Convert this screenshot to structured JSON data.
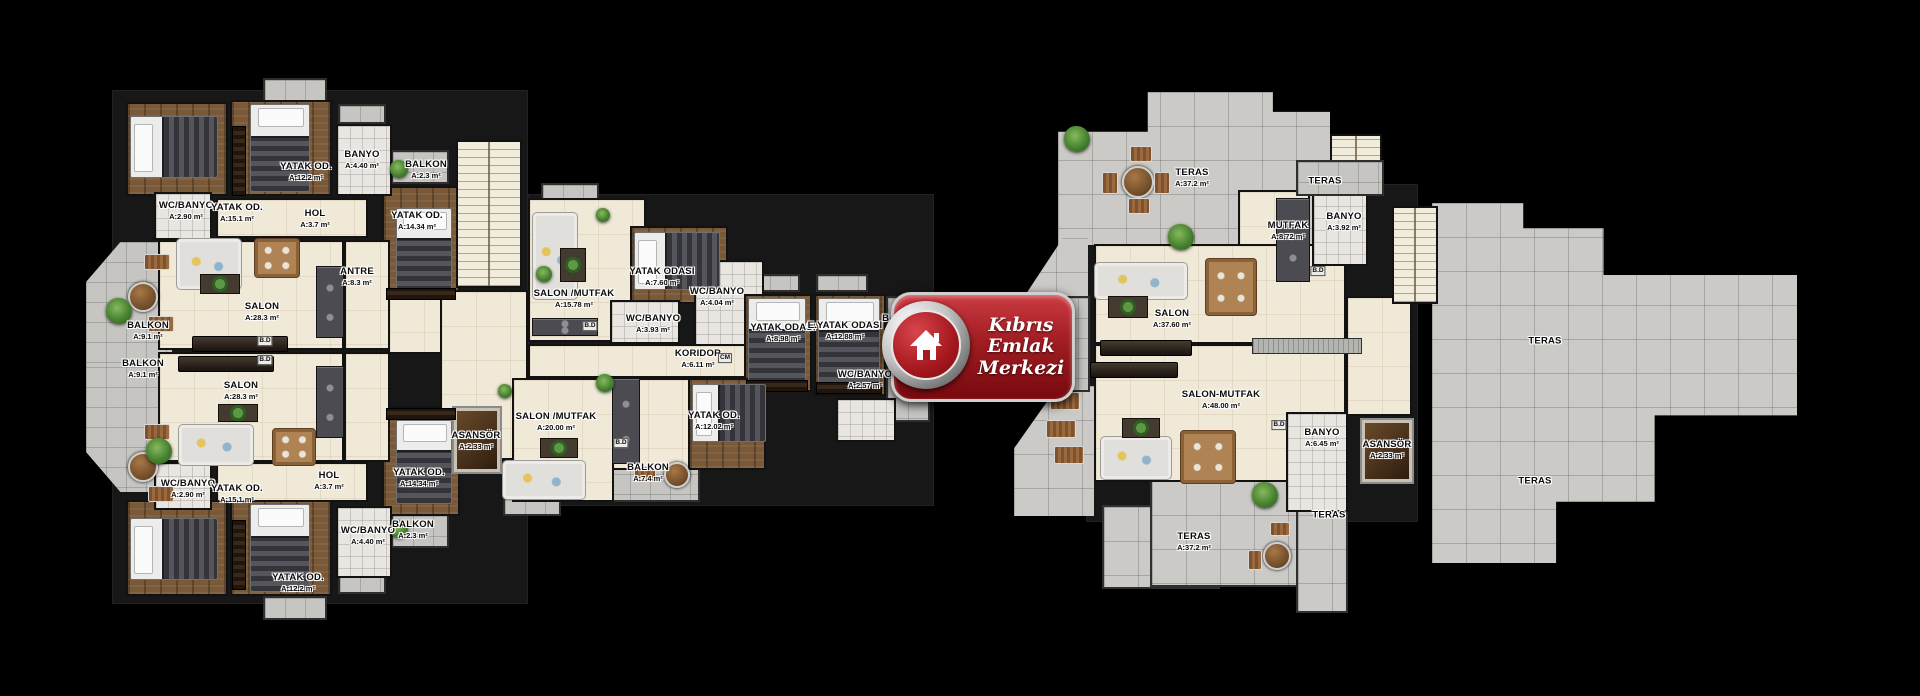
{
  "logo": {
    "lines": [
      "Kıbrıs",
      "Emlak",
      "Merkezi"
    ],
    "x": 891,
    "y": 292,
    "w": 178,
    "h": 104,
    "red": "#a01d22"
  },
  "colors": {
    "background": "#000000",
    "floor_beige": "#f0e9d7",
    "floor_wood": "#7a5938",
    "tile_gray": "#c6c5c1",
    "terrace_gray": "#cbcac6",
    "logo_red": "#a01d22"
  },
  "plan": {
    "typeNames": {
      "bk": "building-footprint",
      "bg": "room-floor",
      "wd": "bedroom-floor",
      "ba": "bathroom-floor",
      "tl": "balcony-tile",
      "t2": "terrace-tile",
      "st": "staircase",
      "lf": "elevator"
    },
    "furnNames": {
      "bv": "bed-icon",
      "bh": "bed-icon",
      "sf": "sofa-icon",
      "tb": "dining-table-icon",
      "cf": "coffee-table-icon",
      "pt": "patio-table-icon",
      "lg": "lounge-chair-icon",
      "pl": "plant-icon",
      "wr": "wardrobe-icon",
      "tv": "tv-console",
      "ct": "kitchen-counter",
      "cl": "kitchen-counter"
    },
    "rooms": [
      [
        "bk",
        112,
        90,
        416,
        514
      ],
      [
        "bk",
        528,
        194,
        406,
        312
      ],
      [
        "bk",
        1086,
        184,
        332,
        338
      ],
      [
        "tl",
        86,
        242,
        86,
        125,
        "polygon(40% 0,100% 0,100% 100%,0 100%,0 32%)"
      ],
      [
        "tl",
        86,
        367,
        86,
        125,
        "polygon(0 0,100% 0,100% 100%,40% 100%,0 68%)"
      ],
      [
        "tl",
        263,
        78,
        64,
        24
      ],
      [
        "tl",
        338,
        104,
        48,
        20
      ],
      [
        "tl",
        391,
        150,
        58,
        34
      ],
      [
        "tl",
        391,
        514,
        58,
        34
      ],
      [
        "tl",
        263,
        596,
        64,
        24
      ],
      [
        "tl",
        338,
        574,
        48,
        20
      ],
      [
        "tl",
        541,
        183,
        58,
        18
      ],
      [
        "tl",
        748,
        274,
        52,
        18
      ],
      [
        "tl",
        816,
        274,
        52,
        18
      ],
      [
        "tl",
        886,
        296,
        44,
        126
      ],
      [
        "tl",
        608,
        452,
        92,
        50
      ],
      [
        "tl",
        503,
        498,
        58,
        18
      ],
      [
        "t2",
        1058,
        92,
        272,
        153,
        "polygon(0 26%,33% 26%,33% 0,79% 0,79% 13%,100% 13%,100% 100%,0 100%)"
      ],
      [
        "t2",
        1102,
        505,
        118,
        84
      ],
      [
        "t2",
        1150,
        479,
        198,
        108
      ],
      [
        "t2",
        1296,
        479,
        52,
        134
      ],
      [
        "t2",
        1432,
        203,
        365,
        360,
        "polygon(0 0,25% 0,25% 7%,47% 7%,47% 20%,100% 20%,100% 59%,61% 59%,61% 83%,34% 83%,34% 100%,0 100%)"
      ],
      [
        "t2",
        1014,
        386,
        80,
        130,
        "polygon(55% 0,100% 0,100% 100%,0 100%,0 48%)"
      ],
      [
        "t2",
        1022,
        238,
        66,
        62,
        "polygon(62% 0,100% 0,100% 100%,0 100%)"
      ],
      [
        "tl",
        1036,
        296,
        54,
        96
      ],
      [
        "wd",
        126,
        102,
        102,
        94
      ],
      [
        "wd",
        230,
        100,
        102,
        96
      ],
      [
        "wd",
        382,
        186,
        78,
        116
      ],
      [
        "wd",
        382,
        406,
        78,
        110
      ],
      [
        "wd",
        126,
        500,
        102,
        96
      ],
      [
        "wd",
        230,
        500,
        102,
        96
      ],
      [
        "ba",
        336,
        124,
        56,
        72
      ],
      [
        "ba",
        154,
        192,
        58,
        48
      ],
      [
        "ba",
        154,
        462,
        58,
        48
      ],
      [
        "ba",
        336,
        506,
        56,
        72
      ],
      [
        "bg",
        216,
        198,
        152,
        40
      ],
      [
        "bg",
        216,
        462,
        152,
        40
      ],
      [
        "bg",
        158,
        240,
        186,
        110
      ],
      [
        "bg",
        158,
        352,
        186,
        110
      ],
      [
        "bg",
        344,
        240,
        46,
        110
      ],
      [
        "bg",
        344,
        352,
        46,
        110
      ],
      [
        "bg",
        388,
        296,
        76,
        58
      ],
      [
        "bg",
        440,
        290,
        88,
        170
      ],
      [
        "st",
        456,
        140,
        66,
        148
      ],
      [
        "lf",
        452,
        406,
        50,
        68
      ],
      [
        "bg",
        528,
        198,
        118,
        144
      ],
      [
        "wd",
        630,
        226,
        98,
        78
      ],
      [
        "ba",
        610,
        300,
        70,
        44
      ],
      [
        "ba",
        694,
        260,
        70,
        86
      ],
      [
        "bg",
        528,
        344,
        218,
        34
      ],
      [
        "wd",
        744,
        294,
        68,
        98
      ],
      [
        "wd",
        814,
        294,
        72,
        102
      ],
      [
        "ba",
        836,
        398,
        60,
        44
      ],
      [
        "bg",
        512,
        378,
        102,
        124
      ],
      [
        "bg",
        612,
        378,
        78,
        92
      ],
      [
        "wd",
        688,
        378,
        78,
        92
      ],
      [
        "bg",
        1094,
        244,
        252,
        100
      ],
      [
        "bg",
        1094,
        344,
        252,
        138
      ],
      [
        "bg",
        1238,
        190,
        72,
        56
      ],
      [
        "ba",
        1312,
        192,
        56,
        74
      ],
      [
        "ba",
        1286,
        412,
        62,
        100
      ],
      [
        "bg",
        1346,
        296,
        66,
        120
      ],
      [
        "lf",
        1360,
        418,
        54,
        66
      ],
      [
        "st",
        1392,
        206,
        46,
        98
      ],
      [
        "st",
        1330,
        134,
        52,
        48
      ],
      [
        "tl",
        1296,
        160,
        88,
        36
      ]
    ],
    "furniture": [
      [
        "bh",
        130,
        116,
        88,
        62
      ],
      [
        "bv",
        250,
        104,
        60,
        88
      ],
      [
        "wr",
        232,
        126,
        14,
        70
      ],
      [
        "bv",
        396,
        208,
        56,
        84
      ],
      [
        "wr",
        386,
        288,
        70,
        12
      ],
      [
        "bh",
        130,
        518,
        88,
        62
      ],
      [
        "bv",
        250,
        504,
        60,
        88
      ],
      [
        "wr",
        232,
        520,
        14,
        70
      ],
      [
        "bv",
        396,
        420,
        56,
        84
      ],
      [
        "wr",
        386,
        408,
        70,
        12
      ],
      [
        "sf",
        176,
        238,
        66,
        52
      ],
      [
        "tb",
        254,
        238,
        46,
        40
      ],
      [
        "cf",
        200,
        274,
        40,
        20
      ],
      [
        "tv",
        192,
        336,
        96,
        16
      ],
      [
        "tv",
        178,
        356,
        96,
        16
      ],
      [
        "sf",
        178,
        424,
        76,
        42
      ],
      [
        "tb",
        272,
        428,
        44,
        38
      ],
      [
        "cf",
        218,
        404,
        40,
        18
      ],
      [
        "ct",
        316,
        266,
        28,
        72
      ],
      [
        "ct",
        316,
        366,
        28,
        72
      ],
      [
        "pt",
        128,
        282,
        30,
        30
      ],
      [
        "lg",
        144,
        254,
        26,
        16
      ],
      [
        "lg",
        148,
        316,
        26,
        16
      ],
      [
        "pl",
        106,
        298,
        26,
        26
      ],
      [
        "pt",
        128,
        452,
        30,
        30
      ],
      [
        "lg",
        144,
        424,
        26,
        16
      ],
      [
        "lg",
        148,
        486,
        26,
        16
      ],
      [
        "pl",
        146,
        438,
        26,
        26
      ],
      [
        "pl",
        390,
        160,
        18,
        18
      ],
      [
        "pl",
        390,
        520,
        18,
        18
      ],
      [
        "sf",
        532,
        212,
        46,
        88
      ],
      [
        "cf",
        560,
        248,
        26,
        34
      ],
      [
        "ct",
        532,
        318,
        66,
        18
      ],
      [
        "pl",
        596,
        208,
        14,
        14
      ],
      [
        "pl",
        536,
        266,
        16,
        16
      ],
      [
        "bh",
        634,
        232,
        86,
        58
      ],
      [
        "bv",
        748,
        298,
        58,
        86
      ],
      [
        "bv",
        818,
        298,
        62,
        90
      ],
      [
        "wr",
        746,
        380,
        62,
        12
      ],
      [
        "wr",
        816,
        382,
        66,
        12
      ],
      [
        "lg",
        890,
        306,
        34,
        20
      ],
      [
        "lg",
        890,
        342,
        34,
        20
      ],
      [
        "sf",
        502,
        460,
        84,
        40
      ],
      [
        "cf",
        540,
        438,
        38,
        20
      ],
      [
        "ct",
        612,
        378,
        28,
        86
      ],
      [
        "pl",
        596,
        374,
        18,
        18
      ],
      [
        "bh",
        692,
        384,
        74,
        58
      ],
      [
        "pt",
        664,
        462,
        26,
        26
      ],
      [
        "lg",
        634,
        466,
        22,
        16
      ],
      [
        "pl",
        498,
        384,
        14,
        14
      ],
      [
        "pt",
        1122,
        166,
        32,
        32
      ],
      [
        "lg",
        1130,
        146,
        22,
        16
      ],
      [
        "lg",
        1102,
        172,
        16,
        22
      ],
      [
        "lg",
        1154,
        172,
        16,
        22
      ],
      [
        "lg",
        1128,
        198,
        22,
        16
      ],
      [
        "pl",
        1064,
        126,
        26,
        26
      ],
      [
        "pl",
        1168,
        224,
        26,
        26
      ],
      [
        "sf",
        1094,
        262,
        94,
        38
      ],
      [
        "tb",
        1205,
        258,
        52,
        58
      ],
      [
        "cf",
        1108,
        296,
        40,
        22
      ],
      [
        "tv",
        1100,
        340,
        92,
        16
      ],
      [
        "tv",
        1090,
        362,
        88,
        16
      ],
      [
        "cl",
        1252,
        338,
        110,
        16
      ],
      [
        "ct",
        1276,
        198,
        34,
        84
      ],
      [
        "sf",
        1100,
        436,
        72,
        44
      ],
      [
        "cf",
        1122,
        418,
        38,
        20
      ],
      [
        "tb",
        1180,
        430,
        56,
        54
      ],
      [
        "pl",
        1024,
        334,
        26,
        26
      ],
      [
        "pl",
        892,
        360,
        24,
        24
      ],
      [
        "lg",
        1050,
        392,
        30,
        18
      ],
      [
        "lg",
        1046,
        420,
        30,
        18
      ],
      [
        "lg",
        1054,
        446,
        30,
        18
      ],
      [
        "pt",
        1263,
        542,
        28,
        28
      ],
      [
        "lg",
        1270,
        522,
        20,
        14
      ],
      [
        "lg",
        1248,
        550,
        14,
        20
      ],
      [
        "pl",
        1252,
        482,
        26,
        26
      ]
    ],
    "labels": [
      [
        "YATAK OD.",
        "A:12.2 m²",
        306,
        172
      ],
      [
        "BANYO",
        "A:4.40 m²",
        362,
        160
      ],
      [
        "WC/BANYO",
        "A:2.90 m²",
        186,
        211
      ],
      [
        "YATAK OD.",
        "A:15.1 m²",
        237,
        213
      ],
      [
        "HOL",
        "A:3.7 m²",
        315,
        219
      ],
      [
        "ANTRE",
        "A:8.3 m²",
        357,
        277
      ],
      [
        "BALKON",
        "A:2.3 m²",
        426,
        170
      ],
      [
        "YATAK OD.",
        "A:14.34 m²",
        417,
        221
      ],
      [
        "SALON",
        "A:28.3 m²",
        262,
        312
      ],
      [
        "BALKON",
        "A:9.1 m²",
        148,
        331
      ],
      [
        "BALKON",
        "A:9.1 m²",
        143,
        369
      ],
      [
        "SALON",
        "A:28.3 m²",
        241,
        391
      ],
      [
        "WC/BANYO",
        "A:2.90 m²",
        188,
        489
      ],
      [
        "YATAK OD.",
        "A:15.1 m²",
        237,
        494
      ],
      [
        "HOL",
        "A:3.7 m²",
        329,
        481
      ],
      [
        "WC/BANYO",
        "A:4.40 m²",
        368,
        536
      ],
      [
        "YATAK OD.",
        "A:12.2 m²",
        298,
        583
      ],
      [
        "BALKON",
        "A:2.3 m²",
        413,
        530
      ],
      [
        "YATAK OD.",
        "A:14.34 m²",
        419,
        478
      ],
      [
        "ASANSÖR",
        "A:2.33 m²",
        476,
        441
      ],
      [
        "SALON /MUTFAK",
        "A:15.78 m²",
        574,
        299
      ],
      [
        "YATAK ODASI",
        "A:7.60 m²",
        662,
        277
      ],
      [
        "WC/BANYO",
        "A:4.04 m²",
        717,
        297
      ],
      [
        "WC/BANYO",
        "A:3.93 m²",
        653,
        324
      ],
      [
        "KORIDOR",
        "A:6.11 m²",
        698,
        359
      ],
      [
        "YATAK ODASI",
        "A:8.98 m²",
        783,
        333
      ],
      [
        "E.YATAK ODASI",
        "A:12.88 m²",
        845,
        331
      ],
      [
        "WC/BANYO",
        "A:2.57 m²",
        865,
        380
      ],
      [
        "BALKON",
        "A:5.6 m²",
        903,
        324
      ],
      [
        "SALON /MUTFAK",
        "A:20.00 m²",
        556,
        422
      ],
      [
        "YATAK OD.",
        "A:12.02 m²",
        714,
        421
      ],
      [
        "BALKON",
        "A:7.4 m²",
        648,
        473
      ],
      [
        "TERAS",
        "A:37.2 m²",
        1192,
        178
      ],
      [
        "TERAS",
        "",
        1325,
        182
      ],
      [
        "MUTFAK",
        "A:8.72 m²",
        1288,
        231
      ],
      [
        "BANYO",
        "A:3.92 m²",
        1344,
        222
      ],
      [
        "SALON",
        "A:37.60 m²",
        1172,
        319
      ],
      [
        "TERAS",
        "A:18.2 m²",
        1057,
        339
      ],
      [
        "SALON-MUTFAK",
        "A:48.00 m²",
        1221,
        400
      ],
      [
        "BANYO",
        "A:6.45 m²",
        1322,
        438
      ],
      [
        "ASANSÖR",
        "A:2.33 m²",
        1387,
        450
      ],
      [
        "TERAS",
        "",
        1329,
        516
      ],
      [
        "TERAS",
        "A:37.2 m²",
        1194,
        542
      ],
      [
        "TERAS",
        "",
        1545,
        342
      ],
      [
        "TERAS",
        "",
        1535,
        482
      ]
    ],
    "tags": [
      [
        "B.D",
        265,
        341
      ],
      [
        "B.D",
        265,
        360
      ],
      [
        "B.D",
        590,
        326
      ],
      [
        "B.D",
        621,
        443
      ],
      [
        "B.D",
        1318,
        271
      ],
      [
        "B.D",
        1279,
        425
      ],
      [
        "CM",
        725,
        358
      ]
    ]
  }
}
